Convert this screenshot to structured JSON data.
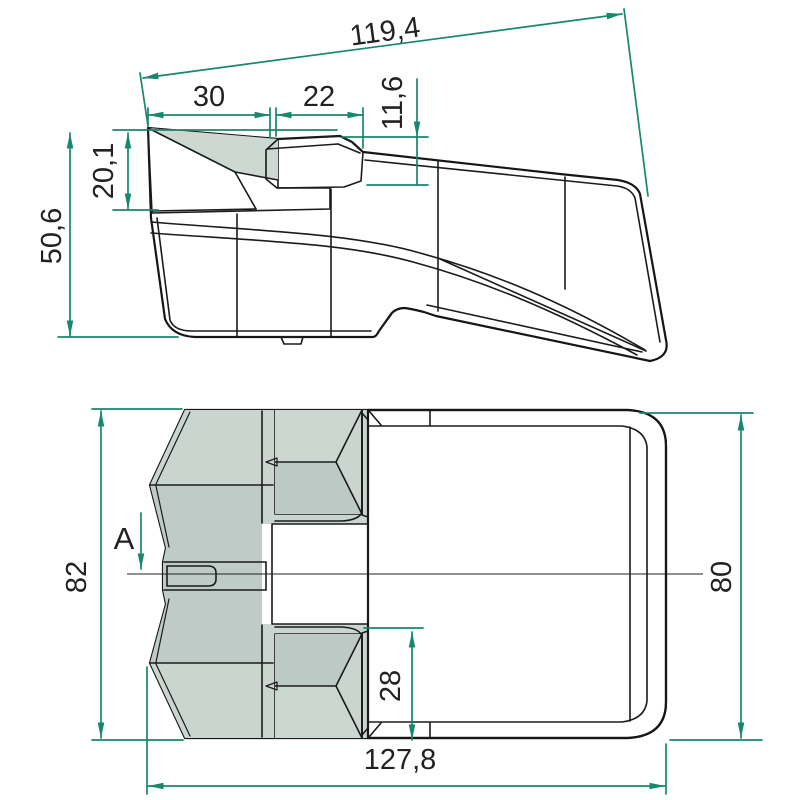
{
  "drawing": {
    "description": "Technical drawing of a bucket tooth point, two orthographic views with dimensions",
    "colors": {
      "dimension_accent": "#17876d",
      "body_dark": "#8aa8a5",
      "body_light": "#c5d1cb",
      "body_mid": "#b5c3be",
      "outline": "#161616",
      "text": "#222222"
    },
    "dims": {
      "side": {
        "total_slant_length": "119,4",
        "tip_length": "30",
        "boss_length": "22",
        "boss_height": "11,6",
        "tip_height": "20,1",
        "overall_height": "50,6"
      },
      "plan": {
        "front_width": "82",
        "rear_width": "80",
        "boss_width": "28",
        "overall_length": "127,8",
        "section_label": "A"
      }
    }
  }
}
